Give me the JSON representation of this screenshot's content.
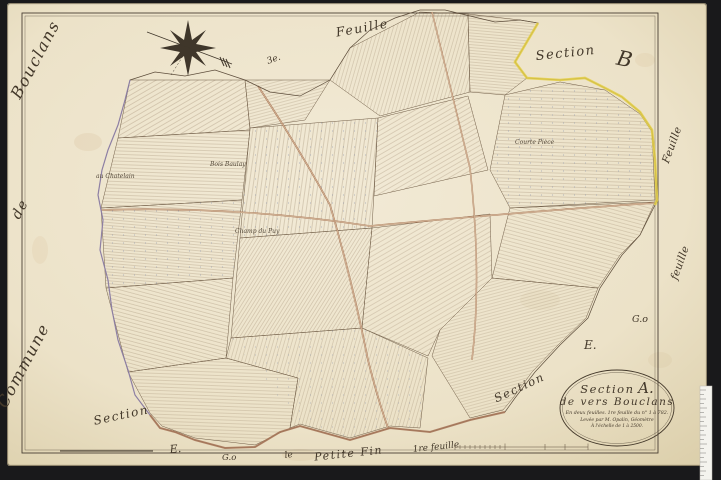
{
  "labels": {
    "commune_word1": "Commune",
    "commune_word2": "de",
    "commune_word3": "Bouclans",
    "feuille_top": "Feuille",
    "section_b_script": "Section",
    "section_b_letter": "B",
    "north_note": "3e.",
    "feuille_right_upper": "Feuille",
    "feuille_right_lower": "feuille",
    "e_right": "E.",
    "go_right": "G.o",
    "section_mid_right": "Section",
    "section_bottom_left": "Section",
    "e_bottom": "E.",
    "go_bottom": "G.o",
    "bottom_le": "le",
    "bottom_place": "Petite Fin",
    "bottom_sheet": "1re feuille"
  },
  "lieux": [
    {
      "text": "au Chatelain"
    },
    {
      "text": "Bois Baulay"
    },
    {
      "text": "Courte Pièce"
    },
    {
      "text": "Champ du Puy"
    }
  ],
  "cartouche": {
    "line1_word": "Section",
    "line1_letter": "A.",
    "line2": "de vers Bouclans",
    "line3": "En deux feuilles. 1re feuille du n° 1 à 782.",
    "line4": "Levée par M. Opalin, Géomètre",
    "line5": "À l'échelle de 1 à 2500."
  },
  "colors": {
    "scan_background": "#19191b",
    "paper": "#ece2c8",
    "ink": "#43382a",
    "parcel_line": "#8a7257",
    "road": "#ad7b5b",
    "boundary_yellow": "#e4cf45",
    "boundary_violet": "#9284b4",
    "number_blue": "#7d89a8"
  }
}
